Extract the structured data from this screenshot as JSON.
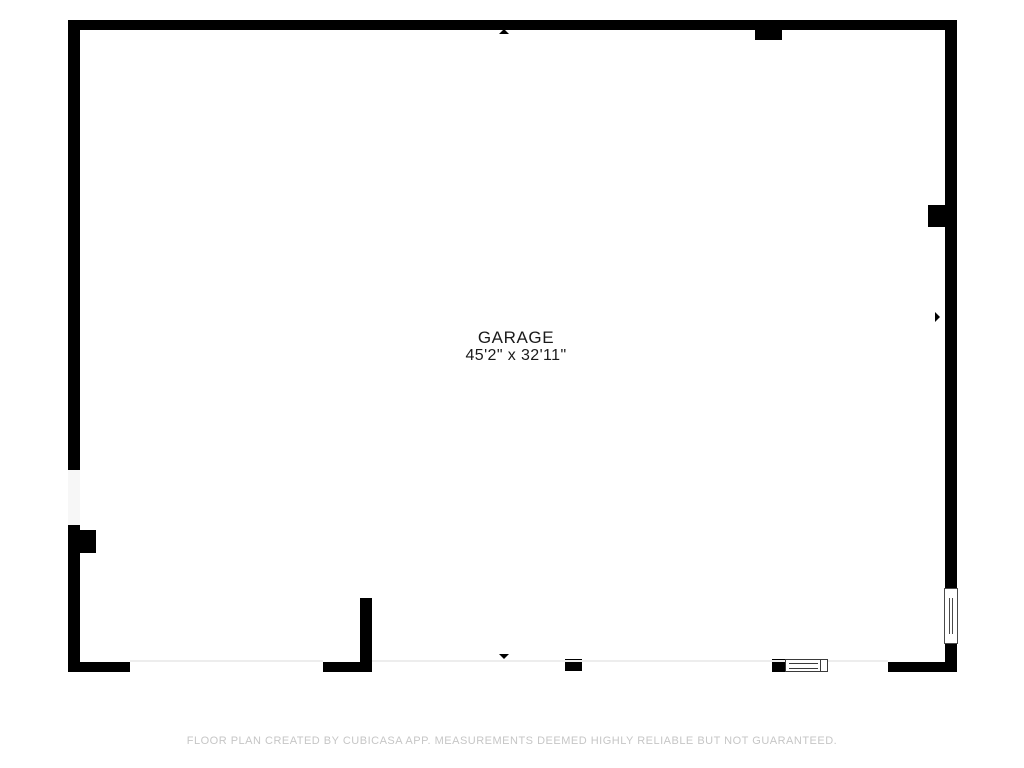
{
  "floor_plan": {
    "room": {
      "name": "GARAGE",
      "dimensions": "45'2\" x 32'11\""
    },
    "footer": "FLOOR PLAN CREATED BY CUBICASA APP. MEASUREMENTS DEEMED HIGHLY RELIABLE BUT NOT GUARANTEED.",
    "icons": {
      "arrow_up": "arrow-up-icon",
      "arrow_down": "arrow-down-icon",
      "arrow_left": "arrow-left-icon",
      "arrow_right": "arrow-right-icon",
      "window_right": "window-icon",
      "window_bottom": "window-icon"
    },
    "colors": {
      "wall": "#000000",
      "room_text": "#1a1a1a",
      "footer_text": "#c6c6c6",
      "opening_fill": "#f7f7f7",
      "door_opening_line": "#ededed",
      "background": "#ffffff"
    }
  }
}
